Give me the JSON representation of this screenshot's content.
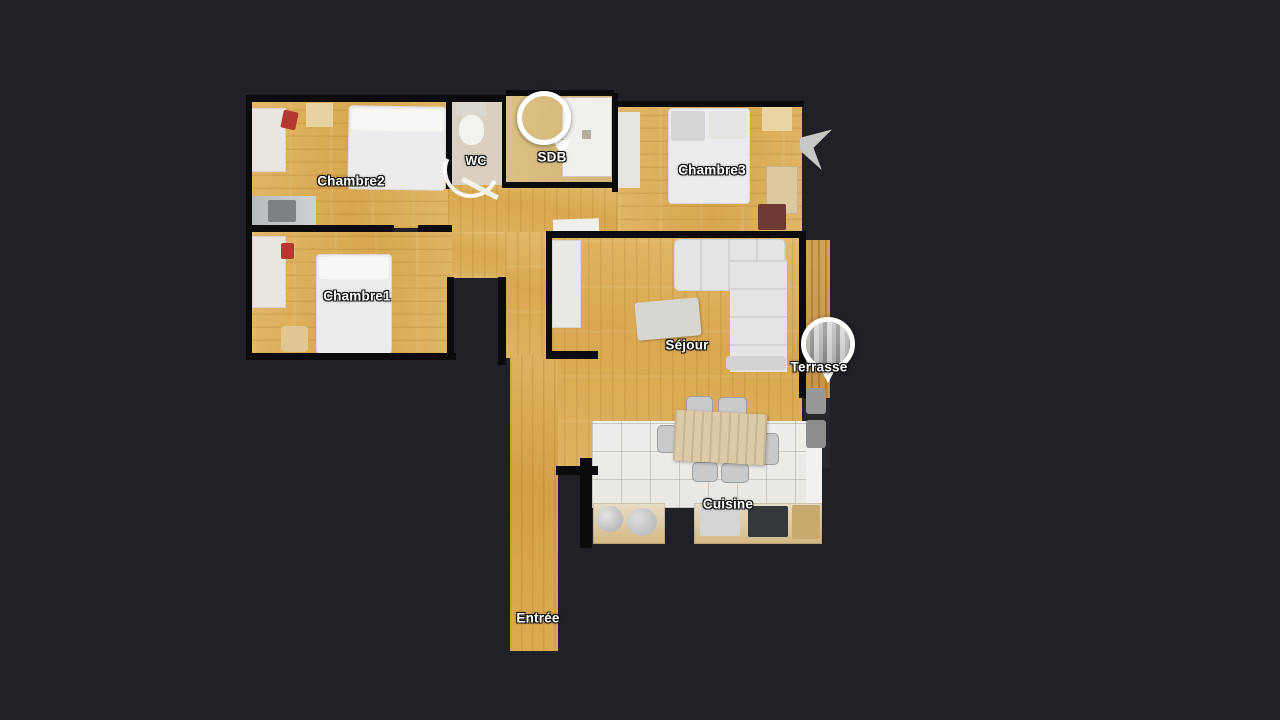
{
  "app": {
    "background_color": "#1f2127",
    "view": "floorplan"
  },
  "floorplan": {
    "wall_color": "#0b0b0d",
    "wood_color": "#d9a850",
    "tile_color": "#edecea",
    "label_color": "#ffffff",
    "rooms": [
      {
        "id": "chambre2",
        "label": "Chambre2"
      },
      {
        "id": "wc",
        "label": "WC"
      },
      {
        "id": "sdb",
        "label": "SDB"
      },
      {
        "id": "chambre3",
        "label": "Chambre3"
      },
      {
        "id": "chambre1",
        "label": "Chambre1"
      },
      {
        "id": "sejour",
        "label": "Séjour"
      },
      {
        "id": "terrasse",
        "label": "Terrasse"
      },
      {
        "id": "cuisine",
        "label": "Cuisine"
      },
      {
        "id": "entree",
        "label": "Entrée"
      }
    ],
    "markers": [
      {
        "id": "sdb-pano",
        "room": "SDB"
      },
      {
        "id": "terrasse-pano",
        "room": "Terrasse"
      }
    ]
  }
}
